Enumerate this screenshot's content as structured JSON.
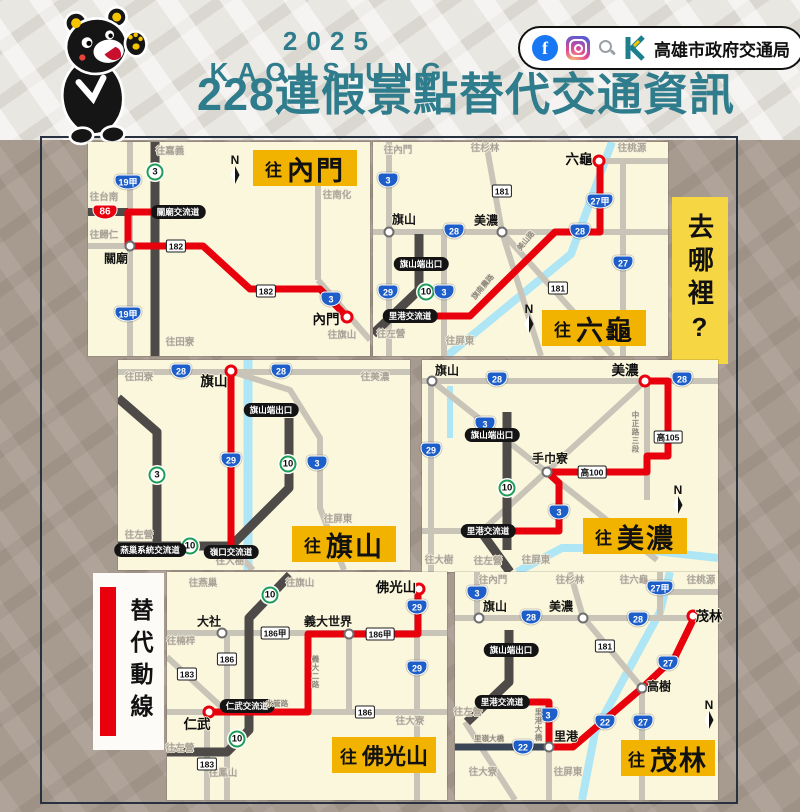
{
  "header": {
    "year": "2025 KAOHSIUNG",
    "title": "228連假景點替代交通資訊",
    "agency": "高雄市政府交通局",
    "icons": [
      "facebook-icon",
      "instagram-icon",
      "search-icon",
      "bureau-k-logo",
      "bear-mascot"
    ]
  },
  "legend": {
    "where_to": "去哪裡?",
    "alt_route": "替代動線"
  },
  "colors": {
    "teal": "#2e7c8c",
    "panel_cream": "#fbf7dc",
    "title_yellow": "#f2b300",
    "where_yellow": "#f7d644",
    "route_red": "#e8000d",
    "shield_blue": "#1e5ec8",
    "shield_green": "#1f9d55",
    "road_gray": "#c9c4b8",
    "road_dark": "#4e4a48",
    "river_blue": "#aee6f5",
    "bg_brown": "#a79a8f"
  },
  "panels": [
    {
      "id": "neimen",
      "items": [
        {
          "t": "dir",
          "x": 82,
          "y": 10,
          "text": "往嘉義"
        },
        {
          "t": "dir",
          "x": 16,
          "y": 56,
          "text": "往台南"
        },
        {
          "t": "dir",
          "x": 16,
          "y": 94,
          "text": "往歸仁"
        },
        {
          "t": "dir",
          "x": 92,
          "y": 201,
          "text": "往田寮"
        },
        {
          "t": "dir",
          "x": 249,
          "y": 54,
          "text": "往南化"
        },
        {
          "t": "dir",
          "x": 254,
          "y": 194,
          "text": "往旗山"
        },
        {
          "t": "sg",
          "x": 67,
          "y": 30,
          "text": "3"
        },
        {
          "t": "sb",
          "x": 40,
          "y": 40,
          "text": "19甲"
        },
        {
          "t": "sb",
          "x": 40,
          "y": 172,
          "text": "19甲"
        },
        {
          "t": "sr",
          "x": 17,
          "y": 70,
          "text": "86"
        },
        {
          "t": "sw",
          "x": 88,
          "y": 104,
          "text": "182"
        },
        {
          "t": "sw",
          "x": 178,
          "y": 149,
          "text": "182"
        },
        {
          "t": "sb",
          "x": 243,
          "y": 157,
          "text": "3"
        },
        {
          "t": "pill",
          "x": 90,
          "y": 70,
          "text": "關廟交流道"
        },
        {
          "t": "place",
          "x": 42,
          "y": 104,
          "lx": 28,
          "ly": 117,
          "text": "關廟"
        },
        {
          "t": "dest",
          "x": 259,
          "y": 175,
          "lx": 238,
          "ly": 178,
          "text": "內門"
        },
        {
          "t": "compass",
          "x": 147,
          "y": 27,
          "text": "N"
        },
        {
          "t": "title",
          "x": 217,
          "y": 26,
          "prefix": "往",
          "text": "內門"
        }
      ]
    },
    {
      "id": "liugui",
      "items": [
        {
          "t": "dir",
          "x": 25,
          "y": 9,
          "text": "往內門"
        },
        {
          "t": "dir",
          "x": 112,
          "y": 7,
          "text": "往杉林"
        },
        {
          "t": "dir",
          "x": 259,
          "y": 7,
          "text": "往桃源"
        },
        {
          "t": "dir",
          "x": 87,
          "y": 200,
          "text": "往屏東"
        },
        {
          "t": "dir",
          "x": 18,
          "y": 193,
          "text": "往左營"
        },
        {
          "t": "place",
          "x": 16,
          "y": 90,
          "lx": 31,
          "ly": 78,
          "text": "旗山"
        },
        {
          "t": "place",
          "x": 129,
          "y": 90,
          "lx": 113,
          "ly": 79,
          "text": "美濃"
        },
        {
          "t": "dest",
          "x": 226,
          "y": 19,
          "lx": 206,
          "ly": 18,
          "text": "六龜"
        },
        {
          "t": "sb",
          "x": 15,
          "y": 38,
          "text": "3"
        },
        {
          "t": "sb",
          "x": 15,
          "y": 150,
          "text": "29"
        },
        {
          "t": "sg",
          "x": 53,
          "y": 150,
          "text": "10"
        },
        {
          "t": "sb",
          "x": 71,
          "y": 150,
          "text": "3"
        },
        {
          "t": "sb",
          "x": 81,
          "y": 89,
          "text": "28"
        },
        {
          "t": "sb",
          "x": 207,
          "y": 89,
          "text": "28"
        },
        {
          "t": "sb",
          "x": 227,
          "y": 59,
          "text": "27甲"
        },
        {
          "t": "sb",
          "x": 250,
          "y": 121,
          "text": "27"
        },
        {
          "t": "sw",
          "x": 129,
          "y": 49,
          "text": "181"
        },
        {
          "t": "sw",
          "x": 185,
          "y": 146,
          "text": "181"
        },
        {
          "t": "pill",
          "x": 48,
          "y": 122,
          "text": "旗山端出口"
        },
        {
          "t": "pill",
          "x": 37,
          "y": 174,
          "text": "里港交流道"
        },
        {
          "t": "rt",
          "x": 153,
          "y": 99,
          "text": "美山路",
          "rot": -50
        },
        {
          "t": "rt",
          "x": 110,
          "y": 145,
          "text": "旗南農路",
          "rot": -50
        },
        {
          "t": "compass",
          "x": 156,
          "y": 176,
          "text": "N"
        },
        {
          "t": "title",
          "x": 221,
          "y": 186,
          "prefix": "往",
          "text": "六龜"
        }
      ]
    },
    {
      "id": "qishan",
      "items": [
        {
          "t": "dir",
          "x": 21,
          "y": 18,
          "text": "往田寮"
        },
        {
          "t": "dir",
          "x": 257,
          "y": 18,
          "text": "往美濃"
        },
        {
          "t": "dir",
          "x": 21,
          "y": 176,
          "text": "往左營"
        },
        {
          "t": "dir",
          "x": 220,
          "y": 160,
          "text": "往屏東"
        },
        {
          "t": "dir",
          "x": 112,
          "y": 202,
          "text": "往大樹"
        },
        {
          "t": "sb",
          "x": 63,
          "y": 11,
          "text": "28"
        },
        {
          "t": "sb",
          "x": 163,
          "y": 11,
          "text": "28"
        },
        {
          "t": "sb",
          "x": 113,
          "y": 100,
          "text": "29"
        },
        {
          "t": "sb",
          "x": 199,
          "y": 103,
          "text": "3"
        },
        {
          "t": "sg",
          "x": 39,
          "y": 115,
          "text": "3"
        },
        {
          "t": "sg",
          "x": 170,
          "y": 104,
          "text": "10"
        },
        {
          "t": "sg",
          "x": 72,
          "y": 186,
          "text": "10"
        },
        {
          "t": "pill",
          "x": 153,
          "y": 50,
          "text": "旗山端出口"
        },
        {
          "t": "pill",
          "x": 32,
          "y": 190,
          "text": "燕巢系統交流道"
        },
        {
          "t": "pill",
          "x": 113,
          "y": 192,
          "text": "嶺口交流道"
        },
        {
          "t": "dest",
          "x": 113,
          "y": 11,
          "lx": 96,
          "ly": 22,
          "text": "旗山"
        },
        {
          "t": "title",
          "x": 226,
          "y": 184,
          "prefix": "往",
          "text": "旗山"
        }
      ]
    },
    {
      "id": "meinong",
      "items": [
        {
          "t": "place",
          "x": 10,
          "y": 21,
          "lx": 25,
          "ly": 11,
          "text": "旗山"
        },
        {
          "t": "dest",
          "x": 223,
          "y": 21,
          "lx": 203,
          "ly": 11,
          "text": "美濃"
        },
        {
          "t": "sb",
          "x": 75,
          "y": 19,
          "text": "28"
        },
        {
          "t": "sb",
          "x": 260,
          "y": 19,
          "text": "28"
        },
        {
          "t": "sb",
          "x": 63,
          "y": 64,
          "text": "3"
        },
        {
          "t": "sb",
          "x": 9,
          "y": 90,
          "text": "29"
        },
        {
          "t": "sb",
          "x": 137,
          "y": 152,
          "text": "3"
        },
        {
          "t": "sg",
          "x": 85,
          "y": 128,
          "text": "10"
        },
        {
          "t": "sw",
          "x": 246,
          "y": 77,
          "text": "高105"
        },
        {
          "t": "sw",
          "x": 170,
          "y": 112,
          "text": "高100"
        },
        {
          "t": "pill",
          "x": 70,
          "y": 75,
          "text": "旗山端出口"
        },
        {
          "t": "pill",
          "x": 66,
          "y": 171,
          "text": "里港交流道"
        },
        {
          "t": "place",
          "x": 125,
          "y": 112,
          "lx": 128,
          "ly": 99,
          "text": "手巾寮"
        },
        {
          "t": "rt",
          "x": 213,
          "y": 72,
          "text": "中正路三段",
          "vert": true
        },
        {
          "t": "dir",
          "x": 17,
          "y": 201,
          "text": "往大樹"
        },
        {
          "t": "dir",
          "x": 66,
          "y": 202,
          "text": "往左營"
        },
        {
          "t": "dir",
          "x": 114,
          "y": 201,
          "text": "往屏東"
        },
        {
          "t": "compass",
          "x": 256,
          "y": 139,
          "text": "N"
        },
        {
          "t": "title",
          "x": 213,
          "y": 176,
          "prefix": "往",
          "text": "美濃"
        }
      ]
    },
    {
      "id": "foguangshan",
      "items": [
        {
          "t": "dir",
          "x": 36,
          "y": 12,
          "text": "往燕巢"
        },
        {
          "t": "dir",
          "x": 133,
          "y": 12,
          "text": "往旗山"
        },
        {
          "t": "dir",
          "x": 14,
          "y": 70,
          "text": "往楠梓"
        },
        {
          "t": "dir",
          "x": 13,
          "y": 177,
          "text": "往左營"
        },
        {
          "t": "dir",
          "x": 56,
          "y": 202,
          "text": "往鳳山"
        },
        {
          "t": "dir",
          "x": 243,
          "y": 150,
          "text": "往大寮"
        },
        {
          "t": "place",
          "x": 55,
          "y": 61,
          "lx": 42,
          "ly": 50,
          "text": "大社"
        },
        {
          "t": "place",
          "x": 182,
          "y": 62,
          "lx": 161,
          "ly": 50,
          "text": "義大世界"
        },
        {
          "t": "dest",
          "x": 252,
          "y": 17,
          "lx": 229,
          "ly": 16,
          "text": "佛光山"
        },
        {
          "t": "dest",
          "x": 42,
          "y": 140,
          "lx": 30,
          "ly": 153,
          "text": "仁武"
        },
        {
          "t": "sg",
          "x": 103,
          "y": 23,
          "text": "10"
        },
        {
          "t": "sg",
          "x": 70,
          "y": 167,
          "text": "10"
        },
        {
          "t": "sb",
          "x": 250,
          "y": 35,
          "text": "29"
        },
        {
          "t": "sb",
          "x": 250,
          "y": 96,
          "text": "29"
        },
        {
          "t": "sw",
          "x": 108,
          "y": 61,
          "text": "186甲"
        },
        {
          "t": "sw",
          "x": 213,
          "y": 62,
          "text": "186甲"
        },
        {
          "t": "sw",
          "x": 60,
          "y": 87,
          "text": "186"
        },
        {
          "t": "sw",
          "x": 20,
          "y": 102,
          "text": "183"
        },
        {
          "t": "sw",
          "x": 198,
          "y": 140,
          "text": "186"
        },
        {
          "t": "sw",
          "x": 40,
          "y": 192,
          "text": "183"
        },
        {
          "t": "pill",
          "x": 80,
          "y": 134,
          "text": "仁武交流道"
        },
        {
          "t": "rt",
          "x": 110,
          "y": 132,
          "text": "水管路"
        },
        {
          "t": "rt",
          "x": 148,
          "y": 100,
          "text": "義大二路",
          "vert": true
        },
        {
          "t": "title",
          "x": 217,
          "y": 183,
          "prefix": "往",
          "text": "佛光山",
          "small": true
        }
      ]
    },
    {
      "id": "maolin",
      "items": [
        {
          "t": "dir",
          "x": 38,
          "y": 9,
          "text": "往內門"
        },
        {
          "t": "dir",
          "x": 115,
          "y": 9,
          "text": "往杉林"
        },
        {
          "t": "dir",
          "x": 179,
          "y": 9,
          "text": "往六龜"
        },
        {
          "t": "dir",
          "x": 246,
          "y": 9,
          "text": "往桃源"
        },
        {
          "t": "dir",
          "x": 13,
          "y": 141,
          "text": "往左營"
        },
        {
          "t": "dir",
          "x": 28,
          "y": 201,
          "text": "往大寮"
        },
        {
          "t": "dir",
          "x": 113,
          "y": 201,
          "text": "往屏東"
        },
        {
          "t": "place",
          "x": 24,
          "y": 46,
          "lx": 40,
          "ly": 35,
          "text": "旗山"
        },
        {
          "t": "place",
          "x": 128,
          "y": 46,
          "lx": 106,
          "ly": 35,
          "text": "美濃"
        },
        {
          "t": "place",
          "x": 187,
          "y": 116,
          "lx": 204,
          "ly": 115,
          "text": "高樹"
        },
        {
          "t": "place",
          "x": 94,
          "y": 175,
          "lx": 111,
          "ly": 165,
          "text": "里港"
        },
        {
          "t": "dest",
          "x": 238,
          "y": 44,
          "lx": 254,
          "ly": 45,
          "text": "茂林"
        },
        {
          "t": "sb",
          "x": 22,
          "y": 21,
          "text": "3"
        },
        {
          "t": "sb",
          "x": 76,
          "y": 45,
          "text": "28"
        },
        {
          "t": "sb",
          "x": 183,
          "y": 47,
          "text": "28"
        },
        {
          "t": "sb",
          "x": 205,
          "y": 16,
          "text": "27甲"
        },
        {
          "t": "sb",
          "x": 213,
          "y": 91,
          "text": "27"
        },
        {
          "t": "sb",
          "x": 188,
          "y": 150,
          "text": "27"
        },
        {
          "t": "sb",
          "x": 150,
          "y": 150,
          "text": "22"
        },
        {
          "t": "sb",
          "x": 68,
          "y": 175,
          "text": "22"
        },
        {
          "t": "sb",
          "x": 93,
          "y": 143,
          "text": "3"
        },
        {
          "t": "sw",
          "x": 150,
          "y": 74,
          "text": "181"
        },
        {
          "t": "pill",
          "x": 56,
          "y": 78,
          "text": "旗山端出口"
        },
        {
          "t": "pill",
          "x": 47,
          "y": 130,
          "text": "里港交流道"
        },
        {
          "t": "rt",
          "x": 83,
          "y": 153,
          "text": "里港大橋",
          "vert": true
        },
        {
          "t": "rt",
          "x": 34,
          "y": 167,
          "text": "里嶺大橋"
        },
        {
          "t": "compass",
          "x": 254,
          "y": 142,
          "text": "N"
        },
        {
          "t": "title",
          "x": 213,
          "y": 186,
          "prefix": "往",
          "text": "茂林",
          "w": 94
        }
      ]
    }
  ]
}
